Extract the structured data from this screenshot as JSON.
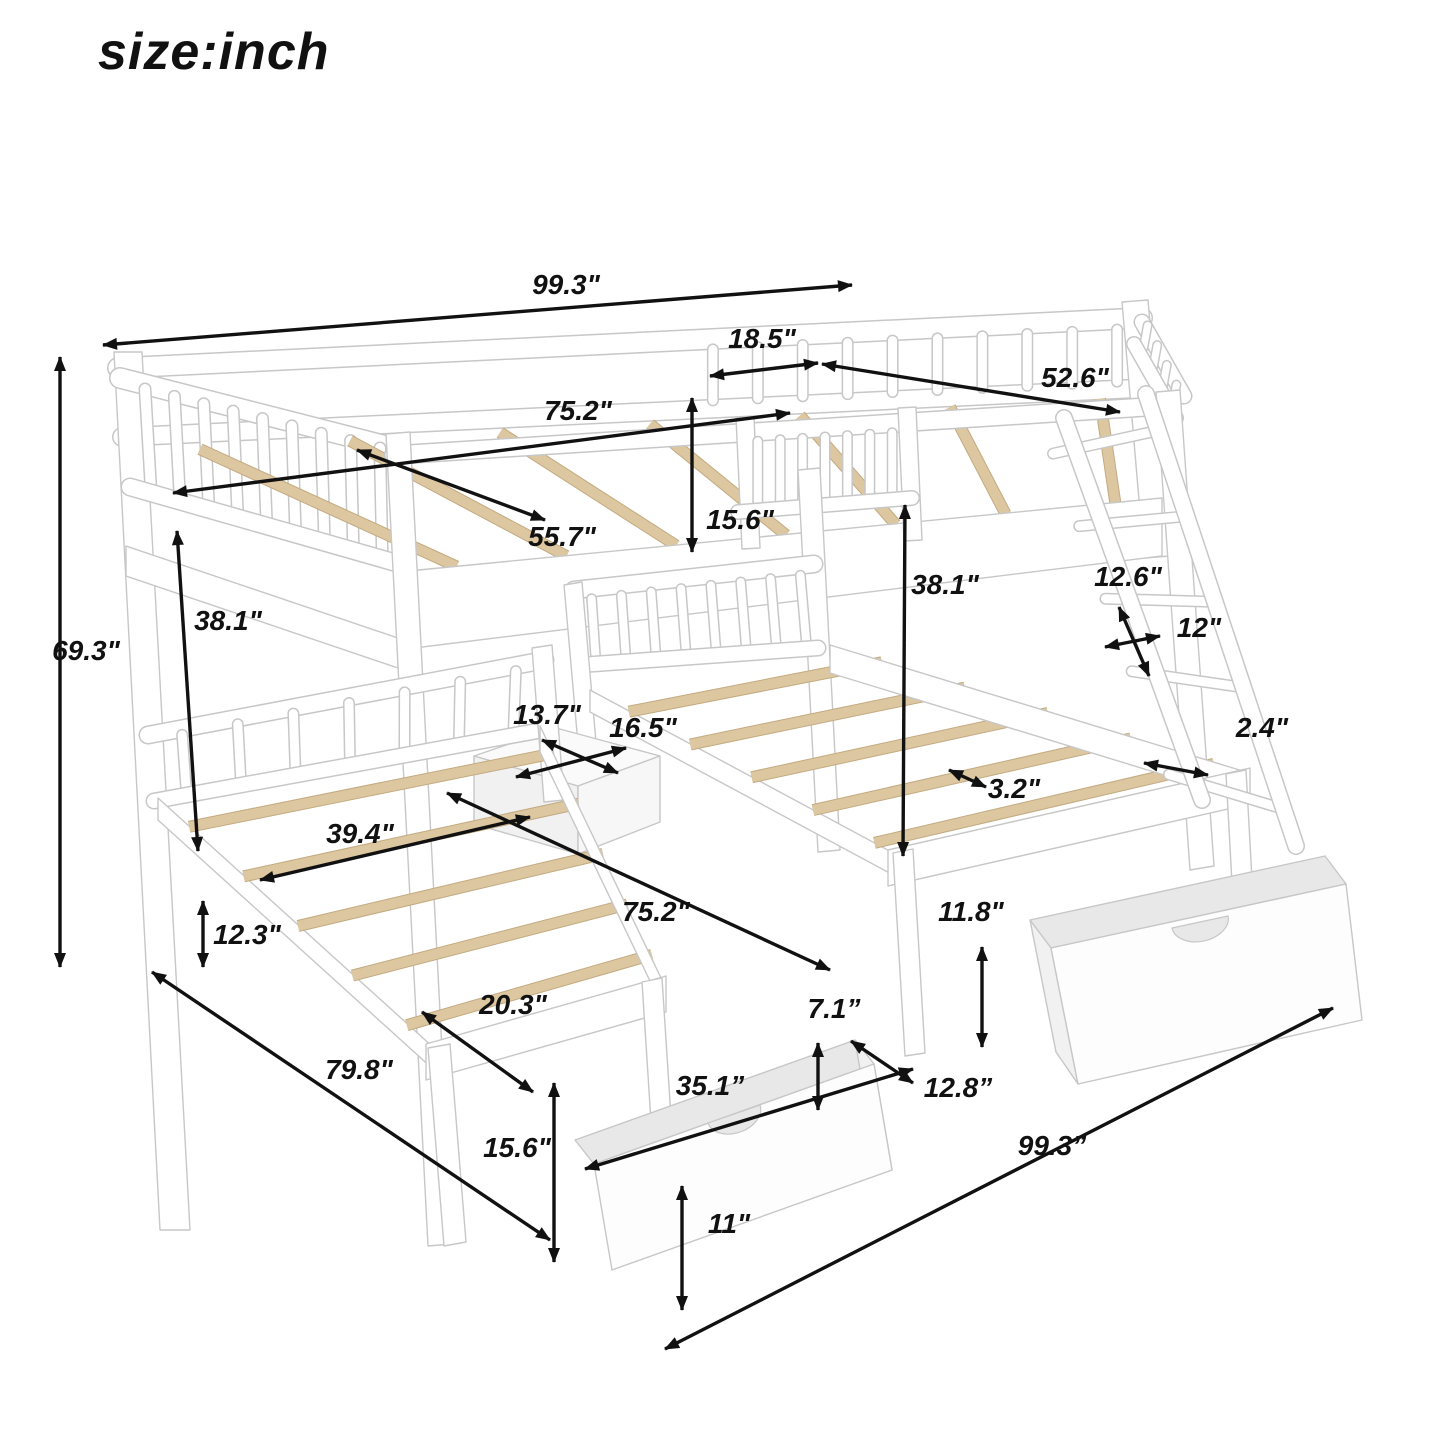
{
  "title": "size:inch",
  "colors": {
    "label": "#111111",
    "arrow": "#111111",
    "frame_stroke": "#c7c7c7",
    "frame_fill": "#ffffff",
    "slat_fill": "#dcc7a1",
    "slat_edge": "#c3aa80"
  },
  "dimensions": [
    {
      "id": "overall-length-top",
      "label": "99.3\"",
      "lx": 566,
      "ly": 294,
      "x1": 103,
      "y1": 345,
      "x2": 852,
      "y2": 285
    },
    {
      "id": "guard-rail-section",
      "label": "18.5\"",
      "lx": 762,
      "ly": 348,
      "x1": 710,
      "y1": 376,
      "x2": 818,
      "y2": 363
    },
    {
      "id": "top-bed-width",
      "label": "52.6\"",
      "lx": 1075,
      "ly": 387,
      "x1": 822,
      "y1": 364,
      "x2": 1120,
      "y2": 412
    },
    {
      "id": "top-bed-length",
      "label": "75.2\"",
      "lx": 578,
      "ly": 420,
      "x1": 173,
      "y1": 493,
      "x2": 790,
      "y2": 413
    },
    {
      "id": "top-rail-height",
      "label": "15.6\"",
      "lx": 740,
      "ly": 529,
      "x1": 692,
      "y1": 398,
      "x2": 692,
      "y2": 552
    },
    {
      "id": "top-slat-length",
      "label": "55.7\"",
      "lx": 562,
      "ly": 546,
      "x1": 357,
      "y1": 450,
      "x2": 545,
      "y2": 520
    },
    {
      "id": "left-bunk-clearance",
      "label": "38.1\"",
      "lx": 228,
      "ly": 630,
      "x1": 177,
      "y1": 531,
      "x2": 198,
      "y2": 851
    },
    {
      "id": "overall-height",
      "label": "69.3\"",
      "lx": 86,
      "ly": 660,
      "x1": 60,
      "y1": 357,
      "x2": 60,
      "y2": 967
    },
    {
      "id": "right-bunk-clearance",
      "label": "38.1\"",
      "lx": 945,
      "ly": 594,
      "x1": 905,
      "y1": 505,
      "x2": 903,
      "y2": 856
    },
    {
      "id": "ladder-step-spacing",
      "label": "12.6\"",
      "lx": 1128,
      "ly": 586,
      "x1": 1119,
      "y1": 607,
      "x2": 1149,
      "y2": 676
    },
    {
      "id": "ladder-width",
      "label": "12\"",
      "lx": 1199,
      "ly": 637,
      "x1": 1105,
      "y1": 647,
      "x2": 1160,
      "y2": 636
    },
    {
      "id": "ladder-step-depth",
      "label": "2.4\"",
      "lx": 1262,
      "ly": 737,
      "x1": 1144,
      "y1": 763,
      "x2": 1208,
      "y2": 775
    },
    {
      "id": "shelf-depth",
      "label": "13.7\"",
      "lx": 547,
      "ly": 724,
      "x1": 542,
      "y1": 740,
      "x2": 618,
      "y2": 773
    },
    {
      "id": "shelf-width",
      "label": "16.5\"",
      "lx": 643,
      "ly": 737,
      "x1": 516,
      "y1": 777,
      "x2": 626,
      "y2": 748
    },
    {
      "id": "twin-bed-width",
      "label": "39.4\"",
      "lx": 360,
      "ly": 843,
      "x1": 260,
      "y1": 880,
      "x2": 530,
      "y2": 817
    },
    {
      "id": "slat-width",
      "label": "3.2\"",
      "lx": 1014,
      "ly": 798,
      "x1": 949,
      "y1": 770,
      "x2": 986,
      "y2": 787
    },
    {
      "id": "rear-leg-height",
      "label": "12.3\"",
      "lx": 247,
      "ly": 944,
      "x1": 203,
      "y1": 901,
      "x2": 203,
      "y2": 967
    },
    {
      "id": "twin-bed-length",
      "label": "75.2\"",
      "lx": 656,
      "ly": 921,
      "x1": 447,
      "y1": 793,
      "x2": 830,
      "y2": 970
    },
    {
      "id": "right-leg-height",
      "label": "11.8\"",
      "lx": 971,
      "ly": 921,
      "x1": 982,
      "y1": 947,
      "x2": 982,
      "y2": 1047
    },
    {
      "id": "foot-overhang",
      "label": "20.3\"",
      "lx": 513,
      "ly": 1014,
      "x1": 422,
      "y1": 1012,
      "x2": 533,
      "y2": 1092
    },
    {
      "id": "drawer-top-gap",
      "label": "7.1”",
      "lx": 834,
      "ly": 1018,
      "x1": 818,
      "y1": 1043,
      "x2": 818,
      "y2": 1110
    },
    {
      "id": "drawer-length",
      "label": "35.1”",
      "lx": 710,
      "ly": 1095,
      "x1": 585,
      "y1": 1169,
      "x2": 913,
      "y2": 1069
    },
    {
      "id": "drawer-depth",
      "label": "12.8”",
      "lx": 958,
      "ly": 1097,
      "x1": 851,
      "y1": 1041,
      "x2": 913,
      "y2": 1083
    },
    {
      "id": "overall-depth",
      "label": "79.8\"",
      "lx": 359,
      "ly": 1079,
      "x1": 152,
      "y1": 972,
      "x2": 550,
      "y2": 1240
    },
    {
      "id": "front-leg-height",
      "label": "15.6\"",
      "lx": 517,
      "ly": 1157,
      "x1": 554,
      "y1": 1083,
      "x2": 554,
      "y2": 1262
    },
    {
      "id": "drawer-height",
      "label": "11\"",
      "lx": 729,
      "ly": 1233,
      "x1": 682,
      "y1": 1186,
      "x2": 682,
      "y2": 1310
    },
    {
      "id": "overall-length-bottom",
      "label": "99.3”",
      "lx": 1052,
      "ly": 1155,
      "x1": 665,
      "y1": 1349,
      "x2": 1333,
      "y2": 1008
    }
  ]
}
